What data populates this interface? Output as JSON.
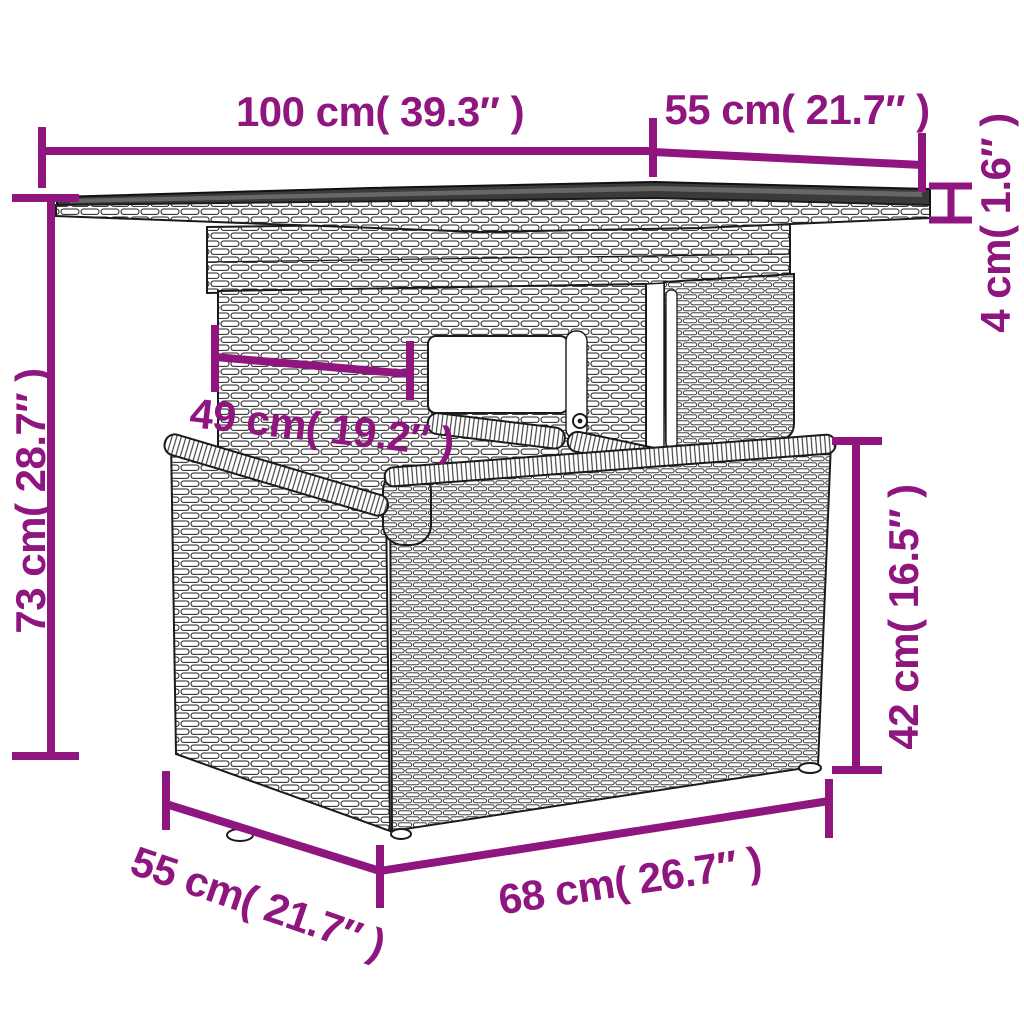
{
  "diagram": {
    "product": "wicker-table-dimension-drawing",
    "dimensions": {
      "tabletop_width": "100 cm( 39.3″ )",
      "tabletop_depth": "55 cm( 21.7″ )",
      "tabletop_thickness": "4 cm( 1.6″ )",
      "total_height": "73 cm( 28.7″ )",
      "pedestal_width": "49 cm( 19.2″ )",
      "base_height": "42 cm( 16.5″ )",
      "base_width": "68 cm( 26.7″ )",
      "base_depth": "55 cm( 21.7″ )"
    },
    "colors": {
      "dimension_accent": "#8F157F",
      "line_art": "#1b1b1b",
      "glass_top": "#3a3a3a",
      "background": "#ffffff"
    }
  }
}
